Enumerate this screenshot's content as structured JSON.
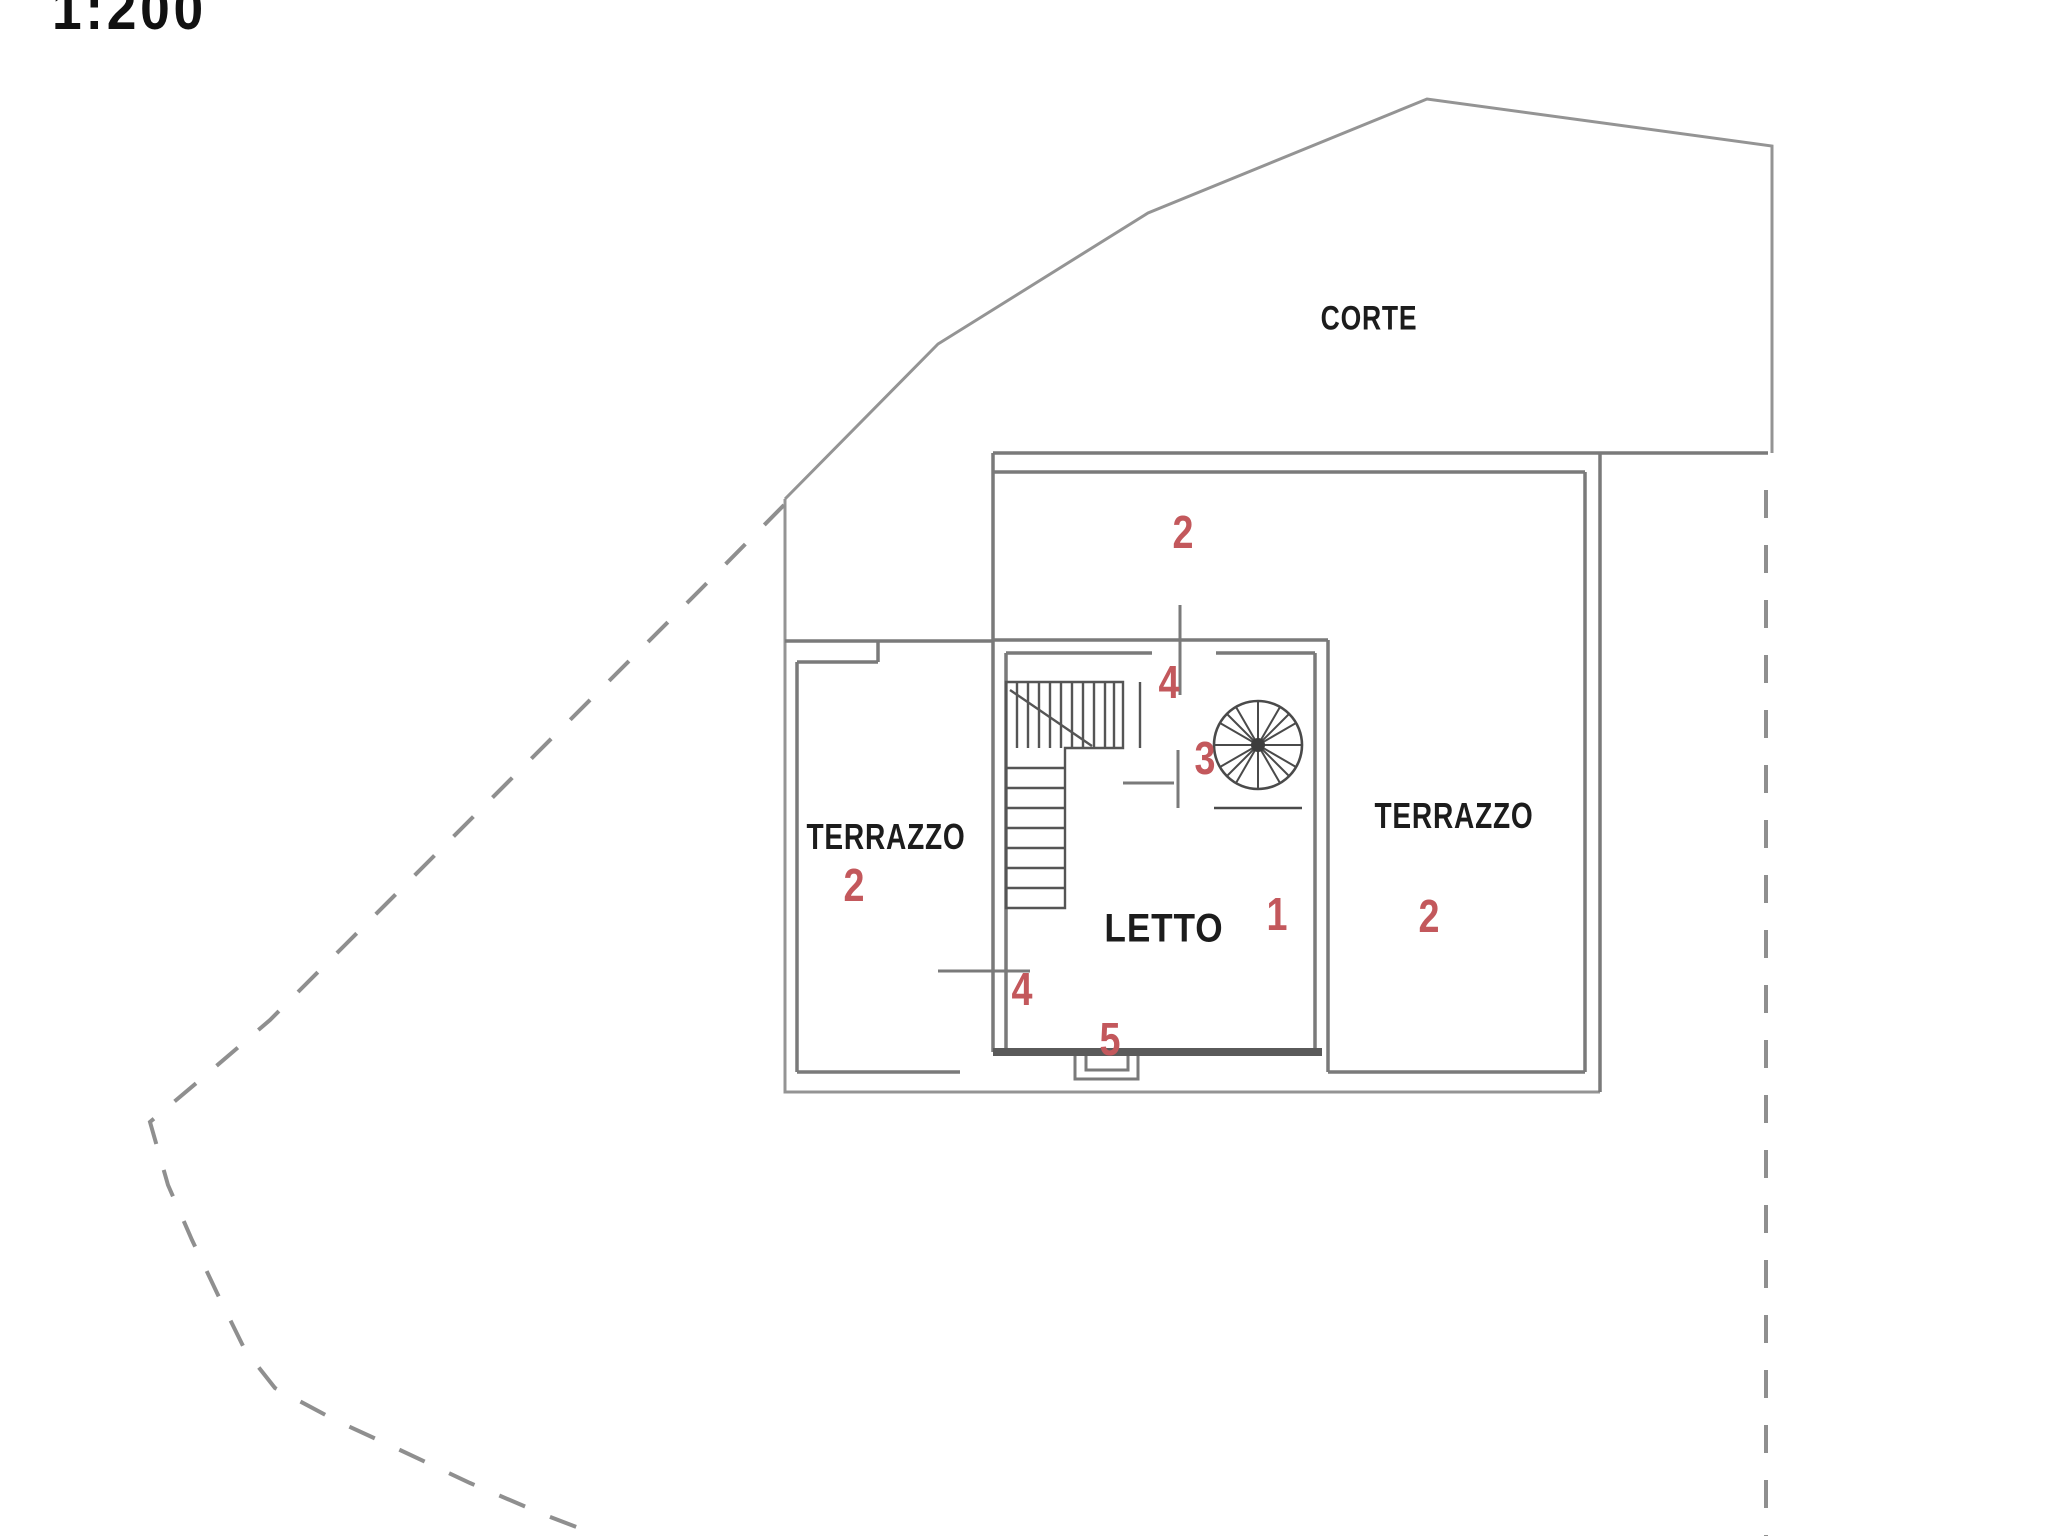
{
  "document": {
    "kind": "cadastral floor plan drawing",
    "scale_label": "1:200"
  },
  "labels": {
    "courtyard": "CORTE",
    "terrace_left": "TERRAZZO",
    "terrace_right": "TERRAZZO",
    "bedroom": "LETTO"
  },
  "unit_numbers": {
    "courtyard_strip": "2",
    "terrace_left": "2",
    "terrace_right": "2",
    "bedroom": "1"
  },
  "opening_numbers": {
    "upper_door": "4",
    "inner_door": "3",
    "west_window": "4",
    "south_door": "5"
  },
  "colors": {
    "line_gray": "#949494",
    "wall_gray": "#7a7a7a",
    "dark_gray": "#555555",
    "text_black": "#1c1c1c",
    "number_red": "#c3585c",
    "background": "#ffffff"
  }
}
